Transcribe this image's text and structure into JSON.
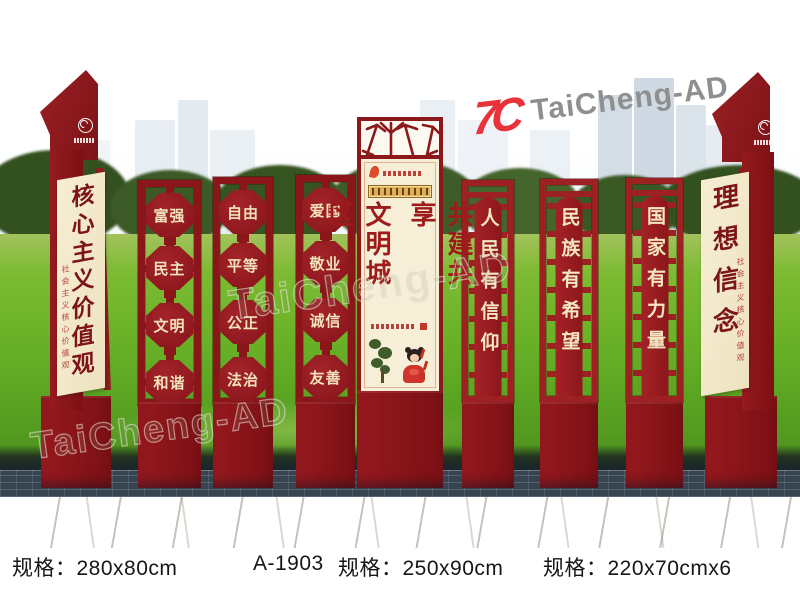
{
  "brand": {
    "mark": "7C",
    "name": "TaiCheng-AD",
    "mark_color": "#e8333b",
    "name_color": "#8f8f8f"
  },
  "watermark": {
    "tiled_text": "TaiCheng-AD"
  },
  "colors": {
    "panel_maroon": "#8c181c",
    "cream": "#f4ebcf",
    "text_maroon": "#7c1418",
    "grass_green": "#69b127",
    "accent_gold": "#ddb257"
  },
  "pillars": {
    "left": {
      "main_text": "核心主义价值观",
      "seal_text": "社会主义核心价值观"
    },
    "right": {
      "main_text": "理想信念",
      "seal_text": "社会主义核心价值观"
    }
  },
  "value_panels": [
    {
      "words": [
        "富强",
        "民主",
        "文明",
        "和谐"
      ]
    },
    {
      "words": [
        "自由",
        "平等",
        "公正",
        "法治"
      ]
    },
    {
      "words": [
        "爱国",
        "敬业",
        "诚信",
        "友善"
      ]
    }
  ],
  "center_panel": {
    "col_right": "共建共享",
    "col_left": "文明城区"
  },
  "slogan_panels": [
    {
      "text": "人民有信仰"
    },
    {
      "text": "民族有希望"
    },
    {
      "text": "国家有力量"
    }
  ],
  "specs": [
    {
      "label": "规格：280x80cm"
    },
    {
      "label": "A-1903"
    },
    {
      "label": "规格：250x90cm"
    },
    {
      "label": "规格：220x70cmx6"
    }
  ]
}
